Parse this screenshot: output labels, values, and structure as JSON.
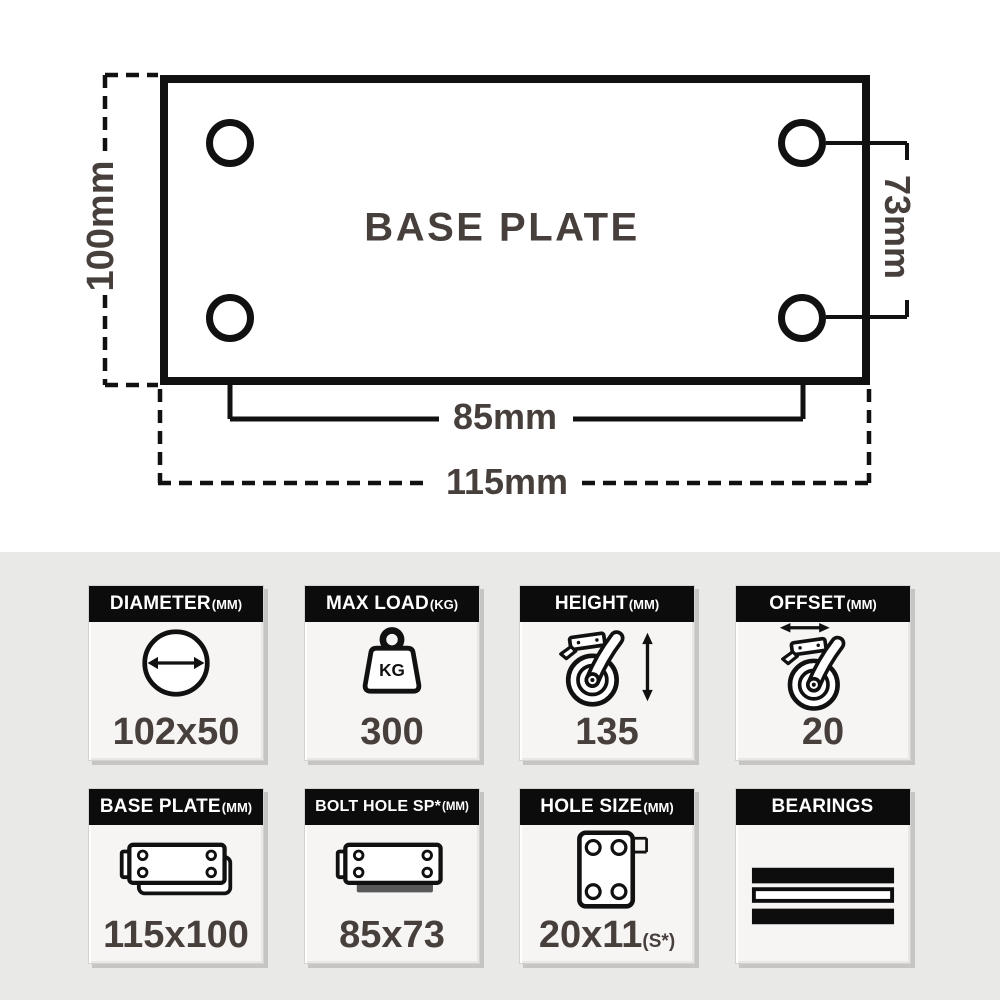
{
  "diagram": {
    "title": "BASE PLATE",
    "height_label": "100mm",
    "bolt_spacing_width_label": "85mm",
    "width_label": "115mm",
    "bolt_spacing_height_label": "73mm"
  },
  "tiles": [
    {
      "label": "DIAMETER",
      "suffix": "(MM)",
      "value": "102x50"
    },
    {
      "label": "MAX LOAD",
      "suffix": "(KG)",
      "value": "300",
      "icon_text": "KG"
    },
    {
      "label": "HEIGHT",
      "suffix": "(MM)",
      "value": "135"
    },
    {
      "label": "OFFSET",
      "suffix": "(MM)",
      "value": "20"
    },
    {
      "label": "BASE PLATE",
      "suffix": "(MM)",
      "value": "115x100"
    },
    {
      "label": "BOLT HOLE SP*",
      "suffix": "(MM)",
      "value": "85x73"
    },
    {
      "label": "HOLE SIZE",
      "suffix": "(MM)",
      "value": "20x11",
      "value_suffix": "(S*)"
    },
    {
      "label": "BEARINGS",
      "suffix": "",
      "value": ""
    }
  ],
  "colors": {
    "line_black": "#111111",
    "label_text": "#473f3c",
    "tile_header_bg": "#0c0c0c",
    "tile_body_bg": "#f6f5f3",
    "section_bg": "#e9e9e8",
    "bolt_shadow_gray": "#595959"
  }
}
